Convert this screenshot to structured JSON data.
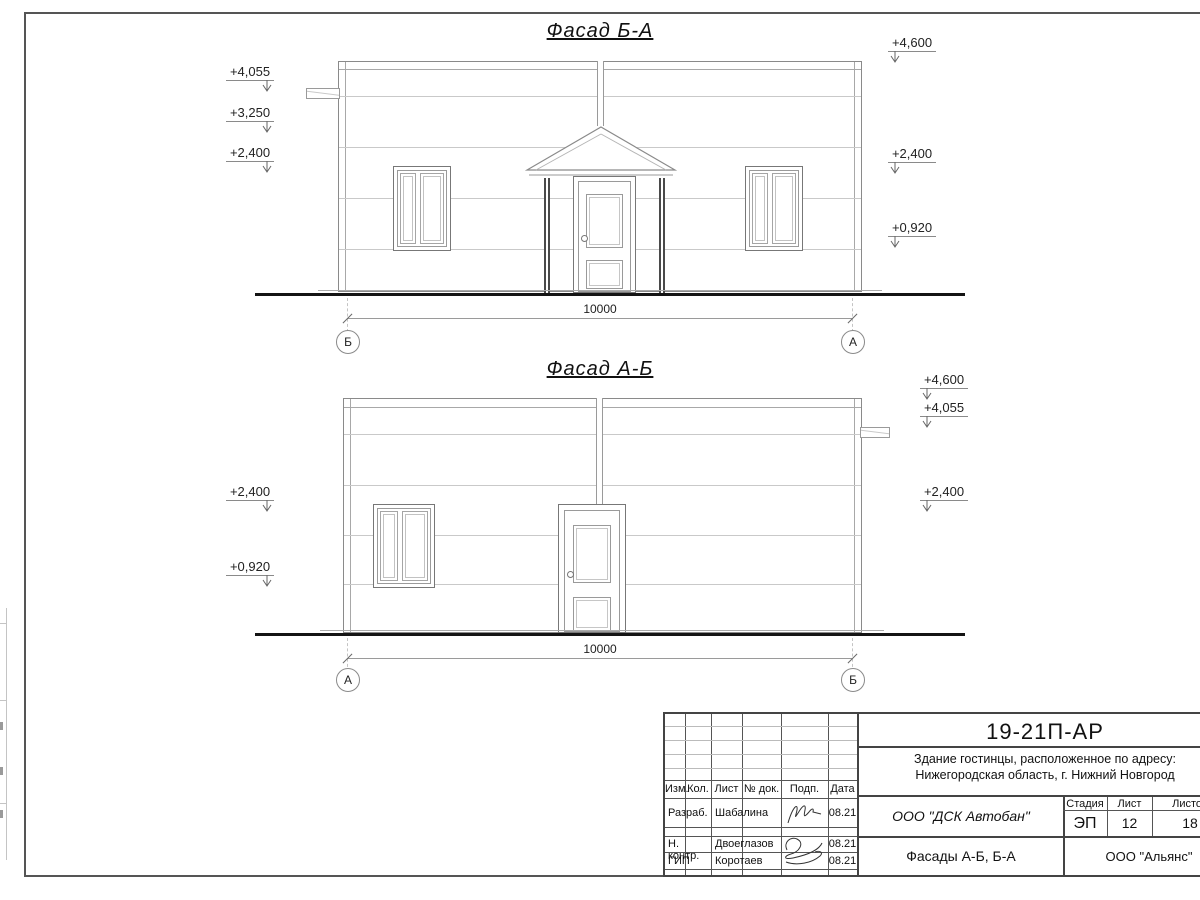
{
  "facades": {
    "top": {
      "title": "Фасад Б-А",
      "dim": "10000",
      "axis_left": "Б",
      "axis_right": "А",
      "marks_left": [
        "+4,055",
        "+3,250",
        "+2,400"
      ],
      "marks_right": [
        "+4,600",
        "+2,400",
        "+0,920"
      ]
    },
    "bottom": {
      "title": "Фасад А-Б",
      "dim": "10000",
      "axis_left": "А",
      "axis_right": "Б",
      "marks_left": [
        "+2,400",
        "+0,920"
      ],
      "marks_right": [
        "+4,600",
        "+4,055",
        "+2,400"
      ]
    }
  },
  "title_block": {
    "code": "19-21П-АР",
    "object_line1": "Здание гостинцы, расположенное по адресу:",
    "object_line2": "Нижегородская область, г. Нижний Новгород",
    "cols": [
      "Изм.",
      "Кол.",
      "Лист",
      "№ док.",
      "Подп.",
      "Дата"
    ],
    "roles": [
      {
        "role": "Разраб.",
        "name": "Шабалина",
        "date": "08.21"
      },
      {
        "role": "Н. контр.",
        "name": "Двоеглазов",
        "date": "08.21"
      },
      {
        "role": "ГИП",
        "name": "Коротаев",
        "date": "08.21"
      }
    ],
    "org": "ООО \"ДСК Автобан\"",
    "stage_label": "Стадия",
    "sheet_label": "Лист",
    "sheets_label": "Листов",
    "stage": "ЭП",
    "sheet_num": "12",
    "sheets_total": "18",
    "doc_title": "Фасады А-Б, Б-А",
    "customer": "ООО \"Альянс\""
  }
}
